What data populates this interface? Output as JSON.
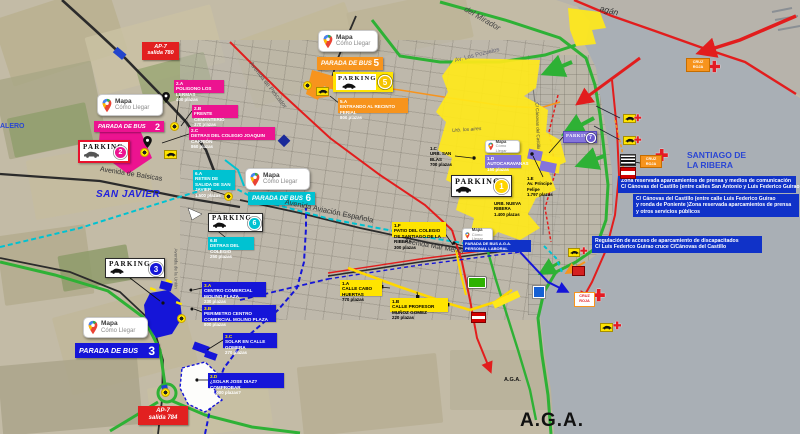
{
  "places": {
    "san_javier": "SAN JAVIER",
    "santiago_line1": "SANTIAGO DE",
    "santiago_line2": "LA RIBERA",
    "aga_large": "A.G.A.",
    "aga_small": "A.G.A.",
    "salero_fragment": "ALERO",
    "pagan_fragment": "agán",
    "urb_los_aires": "Urb. los aires"
  },
  "roads": {
    "balsicas": "Avenida de Balsicas",
    "aviacion": "Avenida Aviación Española",
    "mar_menor": "Avenida Mar Menor",
    "pozuelos": "Av. Los Pozuelos",
    "pescador": "Avenida de Pescador",
    "mirador": "del Mirador",
    "union": "Avenida de la Unión",
    "canovas": "C/ Cánovas del Castillo"
  },
  "motorway_exits": {
    "e780": {
      "name": "AP-7",
      "detail": "salida 780"
    },
    "e784": {
      "name": "AP-7",
      "detail": "salida 784"
    }
  },
  "mapa_card": {
    "line1": "Mapa",
    "line2": "Cómo Llegar"
  },
  "bus_stops": {
    "stop2": {
      "label": "PARADA DE BUS",
      "number": "2",
      "color": "#ec1390"
    },
    "stop3": {
      "label": "PARADA DE BUS",
      "number": "3",
      "color": "#1515d8"
    },
    "stop5": {
      "label": "PARADA DE BUS",
      "number": "5",
      "color": "#f7941d"
    },
    "stop6": {
      "label": "PARADA DE BUS",
      "number": "6",
      "color": "#00c2d1"
    },
    "stop_aga": {
      "line1": "PARADA DE BUS A.G.A.",
      "line2": "PERSONAL LABORAL",
      "color": "#1515d8"
    }
  },
  "parkings": {
    "p1": {
      "label": "PARKING",
      "number": "1",
      "color": "#ffd400"
    },
    "p2": {
      "label": "PARKING",
      "number": "2",
      "color": "#e8112d"
    },
    "p3": {
      "label": "PARKING",
      "number": "3",
      "color": "#1515d8"
    },
    "p5": {
      "label": "PARKING",
      "number": "5",
      "color": "#ffe400"
    },
    "p6": {
      "label": "PARKING",
      "number": "6",
      "color": "#00c2d1"
    },
    "p7": {
      "label": "PARKING",
      "number": "7",
      "color": "#8474dc"
    }
  },
  "zones": {
    "z2a": {
      "id": "2.A",
      "name": "POLIGONO LOS LERMAS",
      "capacity": "400 plazas"
    },
    "z2b": {
      "id": "2.B",
      "name": "FRENTE CEMENTERIO",
      "capacity": "370 plazas"
    },
    "z2c": {
      "id": "2.C",
      "name": "DETRAS DEL COLEGIO JOAQUIN CARRIÓN",
      "capacity": "860 plazas"
    },
    "z5a": {
      "id": "5.A",
      "name": "ENTRANDO AL RECINTO FERIAL",
      "capacity": "800 plazas"
    },
    "z6a": {
      "id": "6.A",
      "name": "RETEN DE SALIDA DE SAN JAVIER",
      "capacity": "1.500 plazas"
    },
    "z6b": {
      "id": "6.B",
      "name": "DETRAS DEL COLEGIO",
      "capacity": "250 plazas"
    },
    "z3a": {
      "id": "3.A",
      "name": "CENTRO COMERCIAL MOLINO PLAZA",
      "capacity": "230 plazas"
    },
    "z3b": {
      "id": "3.B",
      "name": "PERIMETRO CENTRO COMERCIAL MOLINO PLAZA",
      "capacity": "800 plazas"
    },
    "z3c": {
      "id": "3.C",
      "name": "SOLAR EN CALLE GOMERA",
      "capacity": "270 plazas"
    },
    "z3d": {
      "id": "3.D",
      "name": "¿SOLAR JOSE DIAZ? COMPROBAR",
      "capacity": "¿1.000 plazas?"
    },
    "z1a": {
      "id": "1.A",
      "name": "CALLE CABO HUERTAS",
      "capacity": "770 plazas"
    },
    "z1b": {
      "id": "1.B",
      "name": "CALLE PROFESOR MUÑOZ GOMEZ",
      "capacity": "220 plazas"
    },
    "z1c": {
      "id": "1.C",
      "name": "URB. SAN BLAS",
      "capacity": "700 plazas"
    },
    "z1d": {
      "id": "1.D",
      "name": "AUTOCARAVANAS",
      "capacity": "150 plazas"
    },
    "z1e": {
      "id": "1.E",
      "name": "Av. Príncipe Felipe",
      "capacity": "1.797 plazas"
    },
    "z1f": {
      "id": "1.F",
      "name": "PATIO DEL COLEGIO DE SANTIAGO DE LA RIBERA",
      "capacity": "300 plazas"
    },
    "z1g": {
      "id": "1.G",
      "name": "URB. NUEVA RIBERA",
      "capacity": "1.400 plazas"
    }
  },
  "notes": {
    "press_zone": {
      "line1": "Zona reservada aparcamientos de prensa y medios de comunicación",
      "line2": "C/ Cánovas del Castillo (entre calles San Antonio y Luis Federico Guirao"
    },
    "canovas_zone": {
      "line1": "C/ Cánovas del Castillo (entre calle Luis Federico Guirao",
      "line2": "y ronda de Poniente )Zona reservada aparcamientos de prensa",
      "line3": "y otros servicios públicos"
    },
    "disabled_zone": {
      "line1": "Regulación de acceso de aparcamiento de discapacitados",
      "line2": "C/ Luis Federico Guirao cruce C/Cánovas del Castillo"
    }
  },
  "aid_station": {
    "line1": "CRUZ",
    "line2": "ROJA"
  },
  "route_colors": {
    "route1_yellow": "#ffd800",
    "route2_red": "#e21d1d",
    "route3_blue": "#1515d8",
    "route5_orange": "#f7941d",
    "route6_cyan": "#00c2d1",
    "route7_purple": "#8474dc",
    "traffic_flow_green": "#2eb135",
    "water": "#a9afb5"
  }
}
